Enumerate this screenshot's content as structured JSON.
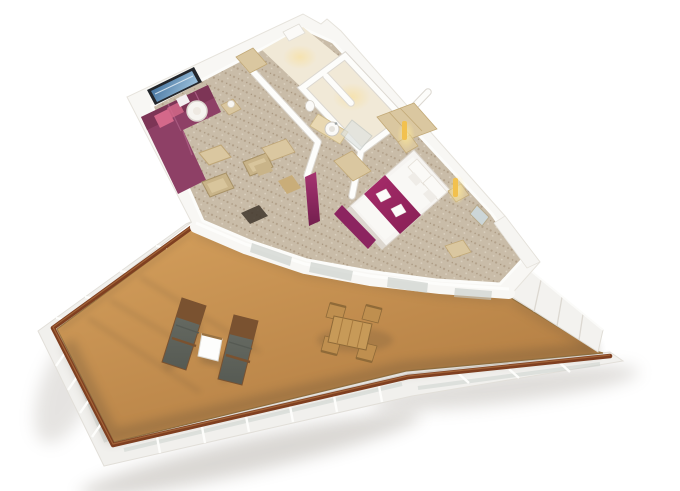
{
  "meta": {
    "width": 680,
    "height": 491,
    "type": "3d-floor-plan-rendering",
    "subject": "suite-with-wraparound-balcony"
  },
  "colors": {
    "background": "#ffffff",
    "wall": "#f8f7f4",
    "wall_edge": "#e6e3dc",
    "wall_line": "#dcd8d1",
    "wall_white": "#fdfdfb",
    "floor_cream": "#f1e9d7",
    "glow_warm": "#f6e2ae",
    "carpet": "#c9bca8",
    "carpet_dark": "#b2a089",
    "carpet_light": "#dbd1c0",
    "deck_light": "#d09b59",
    "deck_dark": "#b07b41",
    "deck_edge": "#9a7642",
    "handrail": "#7f3f20",
    "handrail_light": "#aa6d3f",
    "rim": "#f1f0ed",
    "glass": "#c6cbc7",
    "partition": "#f3f2ef",
    "shadow": "#5a4834",
    "drop_shadow": "#8d857a",
    "sofa": "#8e4066",
    "sofa_dark": "#74304f",
    "sofa_seam": "#a75a80",
    "pillow_pink": "#d4688a",
    "pillow_white": "#f4eff1",
    "lamp_white": "#f6f4f0",
    "tv_frame": "#23262b",
    "tv_blue_dark": "#2f5f8f",
    "tv_blue_light": "#9fc4de",
    "wood_light": "#dac7a0",
    "wood_mid": "#c9ad79",
    "wood_dark": "#9a6a36",
    "counter": "#e9d8b2",
    "porcelain": "#fbfaf8",
    "shower_glass": "#dfe3e0",
    "bed_white": "#f6f4f1",
    "duvet": "#f9f8f5",
    "bed_shadow": "#ddd7cf",
    "runner": "#a82c6b",
    "runner_dark": "#871f55",
    "towel": "#fcfbfa",
    "bench": "#8c2460",
    "pillar_top": "#a63371",
    "pillar_bottom": "#731f4e",
    "sconce": "#f2c14e",
    "sconce_glow": "#f9e59a",
    "mirror": "#ccd6d8",
    "armchair": "#c9b489",
    "armchair_light": "#d8c59c",
    "mat": "#3f362b",
    "lounger_cushion": "#6a6e66",
    "lounger_cushion_dark": "#565a53",
    "lounger_wood": "#7a5230",
    "side_table_white": "#fdfdfc",
    "dining_wood": "#c79a58",
    "dining_wood_dark": "#8f6a38",
    "chair_wood": "#bf8f4f"
  },
  "scene": {
    "suite": {
      "rooms": [
        {
          "name": "living-room",
          "furniture": [
            "sectional-sofa",
            "wall-tv",
            "drum-floor-lamp",
            "side-table-lamp",
            "coffee-table",
            "armchair",
            "armchair",
            "writing-desk",
            "desk-chair",
            "door-mat"
          ]
        },
        {
          "name": "entry-hall",
          "furniture": [
            "entry-door",
            "closet"
          ]
        },
        {
          "name": "bathroom",
          "furniture": [
            "vanity-counter",
            "round-sink",
            "toilet",
            "shower-enclosure"
          ]
        },
        {
          "name": "corridor",
          "furniture": [
            "wardrobe-units",
            "accent-pillar"
          ]
        },
        {
          "name": "bedroom",
          "furniture": [
            "double-bed",
            "pillows",
            "magenta-bed-runner",
            "folded-towels",
            "foot-bench",
            "nightstand",
            "nightstand",
            "wall-sconce",
            "wall-sconce",
            "wardrobe",
            "mirror"
          ]
        }
      ]
    },
    "balcony": {
      "deck": "teak-deck",
      "railing": "glass-panel-railing-with-wood-handrail",
      "privacy_partition": "white-panel-partition",
      "furniture": [
        "sun-lounger",
        "sun-lounger",
        "cocktail-table",
        "dining-table",
        "dining-chair",
        "dining-chair",
        "dining-chair",
        "dining-chair"
      ]
    }
  }
}
